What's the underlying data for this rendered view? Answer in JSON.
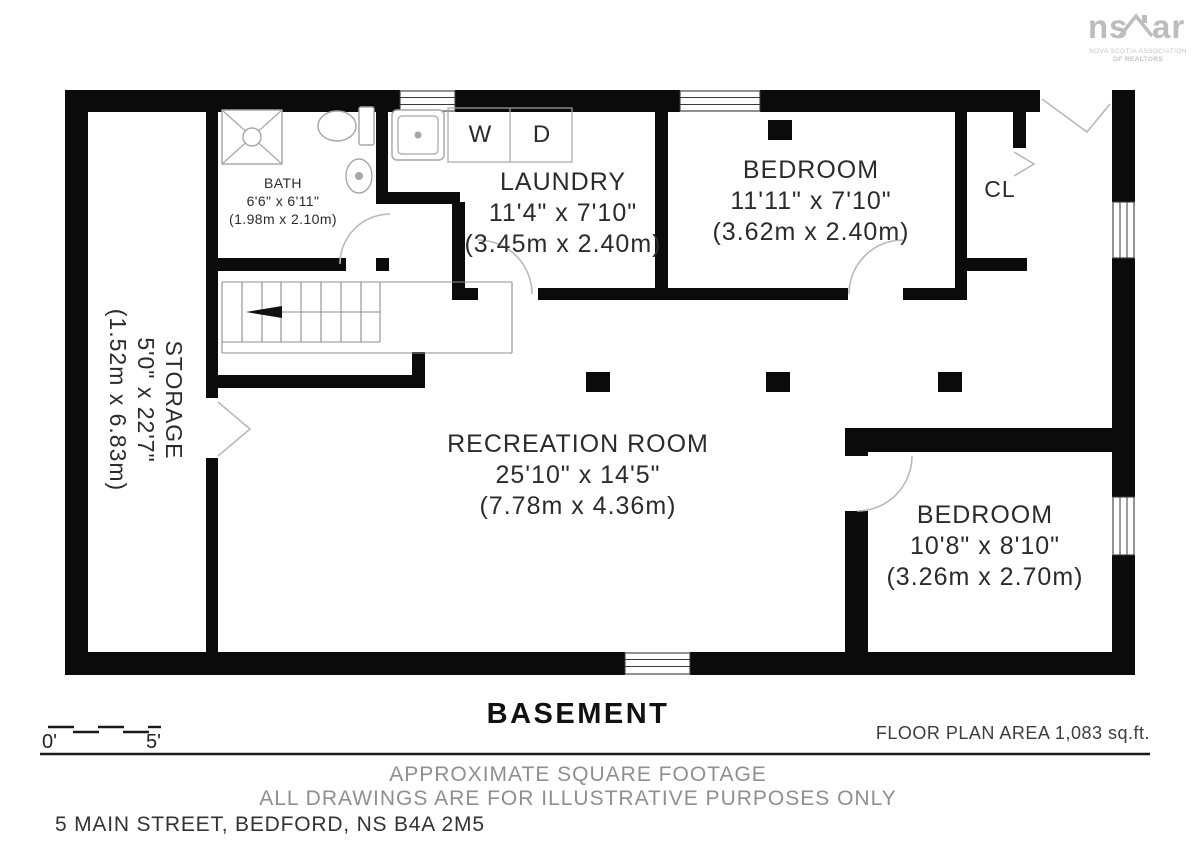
{
  "logo": {
    "left": "ns",
    "right": "ar",
    "subtitle_line1": "NOVA SCOTIA ASSOCIATION",
    "subtitle_line2": "OF REALTORS"
  },
  "rooms": {
    "bath": {
      "name": "BATH",
      "imperial": "6'6\" x 6'11\"",
      "metric": "(1.98m x 2.10m)"
    },
    "laundry": {
      "name": "LAUNDRY",
      "imperial": "11'4\" x 7'10\"",
      "metric": "(3.45m x 2.40m)"
    },
    "bedroom1": {
      "name": "BEDROOM",
      "imperial": "11'11\" x 7'10\"",
      "metric": "(3.62m x 2.40m)"
    },
    "closet": {
      "name": "CL"
    },
    "storage": {
      "name": "STORAGE",
      "imperial": "5'0\" x 22'7\"",
      "metric": "(1.52m x 6.83m)"
    },
    "recreation": {
      "name": "RECREATION ROOM",
      "imperial": "25'10\" x 14'5\"",
      "metric": "(7.78m x 4.36m)"
    },
    "bedroom2": {
      "name": "BEDROOM",
      "imperial": "10'8\" x 8'10\"",
      "metric": "(3.26m x 2.70m)"
    }
  },
  "appliances": {
    "washer": "W",
    "dryer": "D"
  },
  "footer": {
    "floor_label": "BASEMENT",
    "scale_start": "0'",
    "scale_end": "5'",
    "area_label": "FLOOR PLAN AREA 1,083 sq.ft.",
    "disclaimer_line1": "APPROXIMATE SQUARE FOOTAGE",
    "disclaimer_line2": "ALL DRAWINGS ARE FOR ILLUSTRATIVE PURPOSES ONLY",
    "address": "5 MAIN STREET, BEDFORD, NS B4A 2M5"
  },
  "colors": {
    "wall": "#0b0b0b",
    "fixture": "#a6a6a6",
    "door": "#b9b9b9",
    "muted": "#8f8f8f",
    "ink": "#2b2b2b",
    "logo": "#bdbdbd"
  }
}
